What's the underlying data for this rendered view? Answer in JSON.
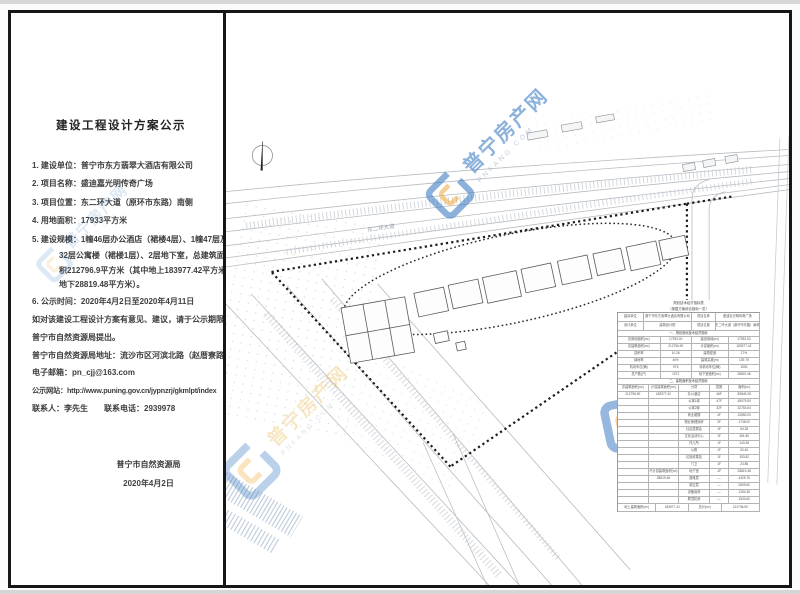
{
  "notice": {
    "title": "建设工程设计方案公示",
    "lines": [
      {
        "t": "1. 建设单位：普宁市东方翡翠大酒店有限公司",
        "k": "item"
      },
      {
        "t": "2. 项目名称：盛迪嘉光明传奇广场",
        "k": "item"
      },
      {
        "t": "3. 项目位置：东二环大道（原环市东路）南侧",
        "k": "item"
      },
      {
        "t": "4. 用地面积：17933平方米",
        "k": "item"
      },
      {
        "t": "5. 建设规模：1幢46层办公酒店（裙楼4层）、1幢47层及1幢",
        "k": "item"
      },
      {
        "t": "32层公寓楼（裙楼1层）、2层地下室，总建筑面",
        "k": "cont"
      },
      {
        "t": "积212796.9平方米（其中地上183977.42平方米，",
        "k": "cont"
      },
      {
        "t": "地下28819.48平方米）。",
        "k": "cont"
      },
      {
        "t": "6. 公示时间：2020年4月2日至2020年4月11日",
        "k": "item"
      },
      {
        "t": "如对该建设工程设计方案有意见、建议，请于公示期限内向",
        "k": "para"
      },
      {
        "t": "普宁市自然资源局提出。",
        "k": "para"
      },
      {
        "t": "普宁市自然资源局地址：流沙市区河滨北路（赵厝寮路段）",
        "k": "para"
      },
      {
        "t": "电子邮箱：pn_cjj@163.com",
        "k": "para"
      },
      {
        "t": "公示网站：http://www.puning.gov.cn/jypnzrj/gkmlpt/index",
        "k": "para tight"
      },
      {
        "t": "联系人：李先生　　联系电话：2939978",
        "k": "para"
      }
    ],
    "signature": {
      "org": "普宁市自然资源局",
      "date": "2020年4月2日"
    }
  },
  "watermark": {
    "brand": "普宁房产网",
    "brand_sub": "PNFANG.COM",
    "blue": "#2f74c0",
    "yellow": "#f2a93b"
  },
  "site_plan": {
    "road_label": "东二环大道",
    "table": {
      "title": "规划技术经济指标表",
      "subtitle": "（报建方案综合指标一览）",
      "rows": [
        {
          "h": 9,
          "c": [
            {
              "t": "建设单位",
              "f": 1.1
            },
            {
              "t": "普宁市东方翡翠大酒店有限公司",
              "f": 2.2
            },
            {
              "t": "项目名称",
              "f": 1
            },
            {
              "t": "盛迪嘉光明传奇广场",
              "f": 2
            }
          ]
        },
        {
          "h": 9,
          "c": [
            {
              "t": "设计单位",
              "f": 1.1
            },
            {
              "t": "建筑设计院",
              "f": 2.2
            },
            {
              "t": "项目位置",
              "f": 1
            },
            {
              "t": "东二环大道（原环市东路）南侧",
              "f": 2
            }
          ]
        },
        {
          "h": 6,
          "s": 1,
          "c": [
            {
              "t": "一、规划用地技术经济指标",
              "f": 1
            }
          ]
        },
        {
          "h": 7,
          "c": [
            {
              "t": "总用地面积(m²)",
              "f": 1.4
            },
            {
              "t": "17933.00",
              "f": 1
            },
            {
              "t": "建设用地(m²)",
              "f": 1.2
            },
            {
              "t": "17933.00",
              "f": 1
            }
          ]
        },
        {
          "h": 7,
          "c": [
            {
              "t": "总建筑面积(m²)",
              "f": 1.4
            },
            {
              "t": "212796.90",
              "f": 1
            },
            {
              "t": "计容面积(m²)",
              "f": 1.2
            },
            {
              "t": "183977.42",
              "f": 1
            }
          ]
        },
        {
          "h": 7,
          "c": [
            {
              "t": "容积率",
              "f": 1.4
            },
            {
              "t": "10.26",
              "f": 1
            },
            {
              "t": "建筑密度",
              "f": 1.2
            },
            {
              "t": "27%",
              "f": 1
            }
          ]
        },
        {
          "h": 7,
          "c": [
            {
              "t": "绿地率",
              "f": 1.4
            },
            {
              "t": "40%",
              "f": 1
            },
            {
              "t": "建筑高度(m)",
              "f": 1.2
            },
            {
              "t": "139.75",
              "f": 1
            }
          ]
        },
        {
          "h": 7,
          "c": [
            {
              "t": "机动车位(辆)",
              "f": 1.4
            },
            {
              "t": "976",
              "f": 1
            },
            {
              "t": "非机动车位(辆)",
              "f": 1.2
            },
            {
              "t": "1530",
              "f": 1
            }
          ]
        },
        {
          "h": 7,
          "c": [
            {
              "t": "总户数(户)",
              "f": 1.4
            },
            {
              "t": "1072",
              "f": 1
            },
            {
              "t": "地下室面积(m²)",
              "f": 1.2
            },
            {
              "t": "28819.48",
              "f": 1
            }
          ]
        },
        {
          "h": 6,
          "s": 1,
          "c": [
            {
              "t": "二、建筑面积技术经济指标",
              "f": 1
            }
          ]
        },
        {
          "h": 7,
          "c": [
            {
              "t": "总建筑面积(m²)",
              "f": 1
            },
            {
              "t": "计容建筑面积(m²)",
              "f": 1
            },
            {
              "t": "分项",
              "f": 1
            },
            {
              "t": "层数",
              "f": 0.6
            },
            {
              "t": "面积(m²)",
              "f": 1
            }
          ]
        },
        {
          "h": 7,
          "c": [
            {
              "t": "212796.90",
              "f": 1
            },
            {
              "t": "183977.42",
              "f": 1
            },
            {
              "t": "办公酒店",
              "f": 1
            },
            {
              "t": "46F",
              "f": 0.6
            },
            {
              "t": "89849.28",
              "f": 1
            }
          ]
        },
        {
          "h": 7,
          "c": [
            {
              "t": "",
              "f": 1
            },
            {
              "t": "",
              "f": 1
            },
            {
              "t": "公寓1幢",
              "f": 1
            },
            {
              "t": "47F",
              "f": 0.6
            },
            {
              "t": "45075.50",
              "f": 1
            }
          ]
        },
        {
          "h": 7,
          "c": [
            {
              "t": "",
              "f": 1
            },
            {
              "t": "",
              "f": 1
            },
            {
              "t": "公寓2幢",
              "f": 1
            },
            {
              "t": "32F",
              "f": 0.6
            },
            {
              "t": "32753.64",
              "f": 1
            }
          ]
        },
        {
          "h": 7,
          "c": [
            {
              "t": "",
              "f": 1
            },
            {
              "t": "",
              "f": 1
            },
            {
              "t": "商业裙楼",
              "f": 1
            },
            {
              "t": "4F",
              "f": 0.6
            },
            {
              "t": "10550.00",
              "f": 1
            }
          ]
        },
        {
          "h": 7,
          "c": [
            {
              "t": "",
              "f": 1
            },
            {
              "t": "",
              "f": 1
            },
            {
              "t": "物业管理用房",
              "f": 1
            },
            {
              "t": "2F",
              "f": 0.6
            },
            {
              "t": "1738.00",
              "f": 1
            }
          ]
        },
        {
          "h": 7,
          "c": [
            {
              "t": "",
              "f": 1
            },
            {
              "t": "",
              "f": 1
            },
            {
              "t": "社区居委会",
              "f": 1
            },
            {
              "t": "1F",
              "f": 0.6
            },
            {
              "t": "54.28",
              "f": 1
            }
          ]
        },
        {
          "h": 7,
          "c": [
            {
              "t": "",
              "f": 1
            },
            {
              "t": "",
              "f": 1
            },
            {
              "t": "文化活动中心",
              "f": 1
            },
            {
              "t": "1F",
              "f": 0.6
            },
            {
              "t": "451.80",
              "f": 1
            }
          ]
        },
        {
          "h": 7,
          "c": [
            {
              "t": "",
              "f": 1
            },
            {
              "t": "",
              "f": 1
            },
            {
              "t": "托儿所",
              "f": 1
            },
            {
              "t": "1F",
              "f": 0.6
            },
            {
              "t": "143.36",
              "f": 1
            }
          ]
        },
        {
          "h": 7,
          "c": [
            {
              "t": "",
              "f": 1
            },
            {
              "t": "",
              "f": 1
            },
            {
              "t": "公厕",
              "f": 1
            },
            {
              "t": "1F",
              "f": 0.6
            },
            {
              "t": "52.40",
              "f": 1
            }
          ]
        },
        {
          "h": 7,
          "c": [
            {
              "t": "",
              "f": 1
            },
            {
              "t": "",
              "f": 1
            },
            {
              "t": "垃圾收集站",
              "f": 1
            },
            {
              "t": "1F",
              "f": 0.6
            },
            {
              "t": "153.82",
              "f": 1
            }
          ]
        },
        {
          "h": 7,
          "c": [
            {
              "t": "",
              "f": 1
            },
            {
              "t": "",
              "f": 1
            },
            {
              "t": "门卫",
              "f": 1
            },
            {
              "t": "1F",
              "f": 0.6
            },
            {
              "t": "24.86",
              "f": 1
            }
          ]
        },
        {
          "h": 7,
          "c": [
            {
              "t": "",
              "f": 1
            },
            {
              "t": "不计容建筑面积(m²)",
              "f": 1
            },
            {
              "t": "地下室",
              "f": 1
            },
            {
              "t": "-2F",
              "f": 0.6
            },
            {
              "t": "28819.48",
              "f": 1
            }
          ]
        },
        {
          "h": 7,
          "c": [
            {
              "t": "",
              "f": 1
            },
            {
              "t": "28819.48",
              "f": 1
            },
            {
              "t": "避难层",
              "f": 1
            },
            {
              "t": "—",
              "f": 0.6
            },
            {
              "t": "4425.76",
              "f": 1
            }
          ]
        },
        {
          "h": 7,
          "c": [
            {
              "t": "",
              "f": 1
            },
            {
              "t": "",
              "f": 1
            },
            {
              "t": "架空层",
              "f": 1
            },
            {
              "t": "—",
              "f": 0.6
            },
            {
              "t": "2809.60",
              "f": 1
            }
          ]
        },
        {
          "h": 7,
          "c": [
            {
              "t": "",
              "f": 1
            },
            {
              "t": "",
              "f": 1
            },
            {
              "t": "设备用房",
              "f": 1
            },
            {
              "t": "—",
              "f": 0.6
            },
            {
              "t": "1254.35",
              "f": 1
            }
          ]
        },
        {
          "h": 7,
          "c": [
            {
              "t": "",
              "f": 1
            },
            {
              "t": "",
              "f": 1
            },
            {
              "t": "屋顶机房",
              "f": 1
            },
            {
              "t": "—",
              "f": 0.6
            },
            {
              "t": "1533.60",
              "f": 1
            }
          ]
        },
        {
          "h": 8,
          "c": [
            {
              "t": "地上建筑面积(m²)",
              "f": 1.2
            },
            {
              "t": "183977.42",
              "f": 1
            },
            {
              "t": "总计(m²)",
              "f": 1
            },
            {
              "t": "212796.90",
              "f": 1.2
            }
          ]
        }
      ]
    }
  }
}
